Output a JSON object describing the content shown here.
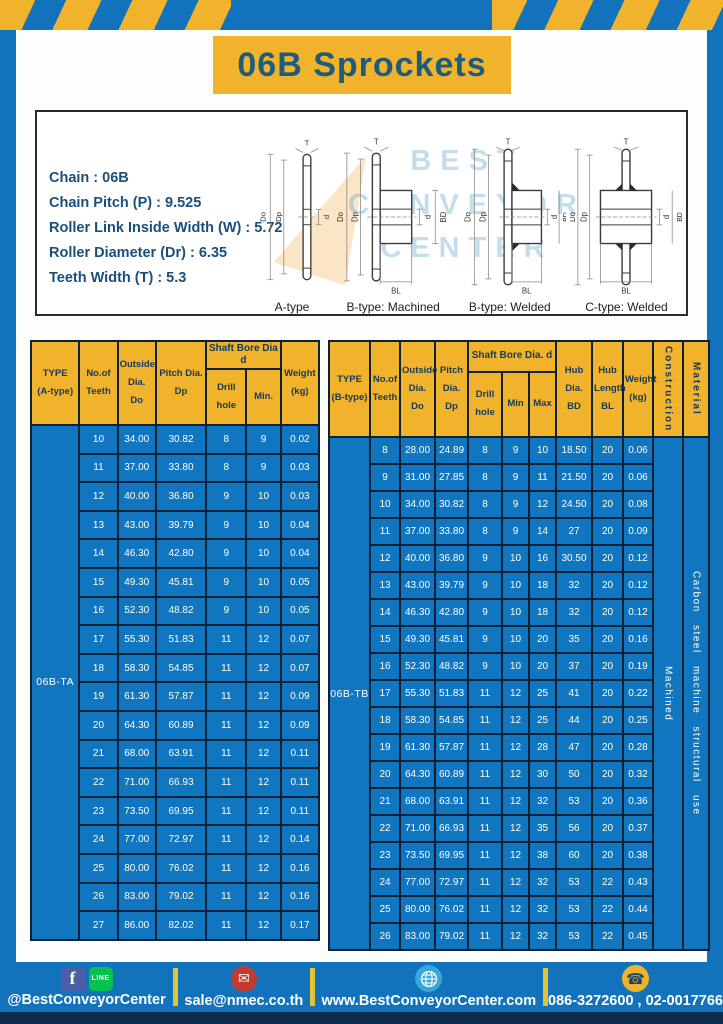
{
  "page": {
    "title": "06B Sprockets"
  },
  "colors": {
    "blue": "#1273BC",
    "yellow": "#F1B32B",
    "navy_text": "#1E5C7D",
    "bottom_strip": "#0D2B4A"
  },
  "specs": {
    "lines": [
      "Chain : 06B",
      "Chain Pitch (P) : 9.525",
      "Roller Link Inside Width (W) : 5.72",
      "Roller Diameter (Dr) : 6.35",
      "Teeth Width (T) : 5.3"
    ]
  },
  "diagram": {
    "watermark_lines": [
      "BEST",
      "CONVEYOR",
      "CENTER"
    ],
    "captions": [
      "A-type",
      "B-type: Machined",
      "B-type: Welded",
      "C-type: Welded"
    ],
    "labels": {
      "t": "T",
      "outside": "Do",
      "pitch": "Dp",
      "bore": "d",
      "hub_dia": "BD",
      "hub_len": "BL"
    }
  },
  "table_a": {
    "headers": {
      "type": [
        "TYPE",
        "(A-type)"
      ],
      "teeth": [
        "No.of",
        "Teeth"
      ],
      "outside": [
        "Outside",
        "Dia.",
        "Do"
      ],
      "pitch": [
        "Pitch Dia.",
        "Dp"
      ],
      "shaft_group": "Shaft Bore Dia d",
      "drill": "Drill hole",
      "min": "Min.",
      "weight": [
        "Weight",
        "(kg)"
      ]
    },
    "type_value": "06B-TA",
    "rows": [
      [
        "10",
        "34.00",
        "30.82",
        "8",
        "9",
        "0.02"
      ],
      [
        "11",
        "37.00",
        "33.80",
        "8",
        "9",
        "0.03"
      ],
      [
        "12",
        "40.00",
        "36.80",
        "9",
        "10",
        "0.03"
      ],
      [
        "13",
        "43.00",
        "39.79",
        "9",
        "10",
        "0.04"
      ],
      [
        "14",
        "46.30",
        "42.80",
        "9",
        "10",
        "0.04"
      ],
      [
        "15",
        "49.30",
        "45.81",
        "9",
        "10",
        "0.05"
      ],
      [
        "16",
        "52.30",
        "48.82",
        "9",
        "10",
        "0.05"
      ],
      [
        "17",
        "55.30",
        "51.83",
        "11",
        "12",
        "0.07"
      ],
      [
        "18",
        "58.30",
        "54.85",
        "11",
        "12",
        "0.07"
      ],
      [
        "19",
        "61.30",
        "57.87",
        "11",
        "12",
        "0.09"
      ],
      [
        "20",
        "64.30",
        "60.89",
        "11",
        "12",
        "0.09"
      ],
      [
        "21",
        "68.00",
        "63.91",
        "11",
        "12",
        "0.11"
      ],
      [
        "22",
        "71.00",
        "66.93",
        "11",
        "12",
        "0.11"
      ],
      [
        "23",
        "73.50",
        "69.95",
        "11",
        "12",
        "0.11"
      ],
      [
        "24",
        "77.00",
        "72.97",
        "11",
        "12",
        "0.14"
      ],
      [
        "25",
        "80.00",
        "76.02",
        "11",
        "12",
        "0.16"
      ],
      [
        "26",
        "83.00",
        "79.02",
        "11",
        "12",
        "0.16"
      ],
      [
        "27",
        "86.00",
        "82.02",
        "11",
        "12",
        "0.17"
      ]
    ]
  },
  "table_b": {
    "headers": {
      "type": [
        "TYPE",
        "(B-type)"
      ],
      "teeth": [
        "No.of",
        "Teeth"
      ],
      "outside": [
        "Outside",
        "Dia.",
        "Do"
      ],
      "pitch": [
        "Pitch",
        "Dia.",
        "Dp"
      ],
      "shaft_group": "Shaft Bore Dia. d",
      "drill": "Drill hole",
      "min": "Min",
      "max": "Max",
      "hub_dia": [
        "Hub",
        "Dia.",
        "BD"
      ],
      "hub_len": [
        "Hub",
        "Length",
        "BL"
      ],
      "weight": [
        "Weight",
        "(kg)"
      ],
      "construction": "Construction",
      "material": "Material"
    },
    "type_value": "06B-TB",
    "construction_value": "Machined",
    "material_value": "Carbon steel machine structural use",
    "rows": [
      [
        "8",
        "28.00",
        "24.89",
        "8",
        "9",
        "10",
        "18.50",
        "20",
        "0.06"
      ],
      [
        "9",
        "31.00",
        "27.85",
        "8",
        "9",
        "11",
        "21.50",
        "20",
        "0.06"
      ],
      [
        "10",
        "34.00",
        "30.82",
        "8",
        "9",
        "12",
        "24.50",
        "20",
        "0.08"
      ],
      [
        "11",
        "37.00",
        "33.80",
        "8",
        "9",
        "14",
        "27",
        "20",
        "0.09"
      ],
      [
        "12",
        "40.00",
        "36.80",
        "9",
        "10",
        "16",
        "30.50",
        "20",
        "0.12"
      ],
      [
        "13",
        "43.00",
        "39.79",
        "9",
        "10",
        "18",
        "32",
        "20",
        "0.12"
      ],
      [
        "14",
        "46.30",
        "42.80",
        "9",
        "10",
        "18",
        "32",
        "20",
        "0.12"
      ],
      [
        "15",
        "49.30",
        "45.81",
        "9",
        "10",
        "20",
        "35",
        "20",
        "0.16"
      ],
      [
        "16",
        "52.30",
        "48.82",
        "9",
        "10",
        "20",
        "37",
        "20",
        "0.19"
      ],
      [
        "17",
        "55.30",
        "51.83",
        "11",
        "12",
        "25",
        "41",
        "20",
        "0.22"
      ],
      [
        "18",
        "58.30",
        "54.85",
        "11",
        "12",
        "25",
        "44",
        "20",
        "0.25"
      ],
      [
        "19",
        "61.30",
        "57.87",
        "11",
        "12",
        "28",
        "47",
        "20",
        "0.28"
      ],
      [
        "20",
        "64.30",
        "60.89",
        "11",
        "12",
        "30",
        "50",
        "20",
        "0.32"
      ],
      [
        "21",
        "68.00",
        "63.91",
        "11",
        "12",
        "32",
        "53",
        "20",
        "0.36"
      ],
      [
        "22",
        "71.00",
        "66.93",
        "11",
        "12",
        "35",
        "56",
        "20",
        "0.37"
      ],
      [
        "23",
        "73.50",
        "69.95",
        "11",
        "12",
        "38",
        "60",
        "20",
        "0.38"
      ],
      [
        "24",
        "77.00",
        "72.97",
        "11",
        "12",
        "32",
        "53",
        "22",
        "0.43"
      ],
      [
        "25",
        "80.00",
        "76.02",
        "11",
        "12",
        "32",
        "53",
        "22",
        "0.44"
      ],
      [
        "26",
        "83.00",
        "79.02",
        "11",
        "12",
        "32",
        "53",
        "22",
        "0.45"
      ]
    ]
  },
  "footer": {
    "social": "@BestConveyorCenter",
    "email": "sale@nmec.co.th",
    "website": "www.BestConveyorCenter.com",
    "phone": "086-3272600 , 02-0017766",
    "icons": {
      "facebook": "f",
      "line": "LINE",
      "email": "✉",
      "phone": "☎"
    }
  }
}
